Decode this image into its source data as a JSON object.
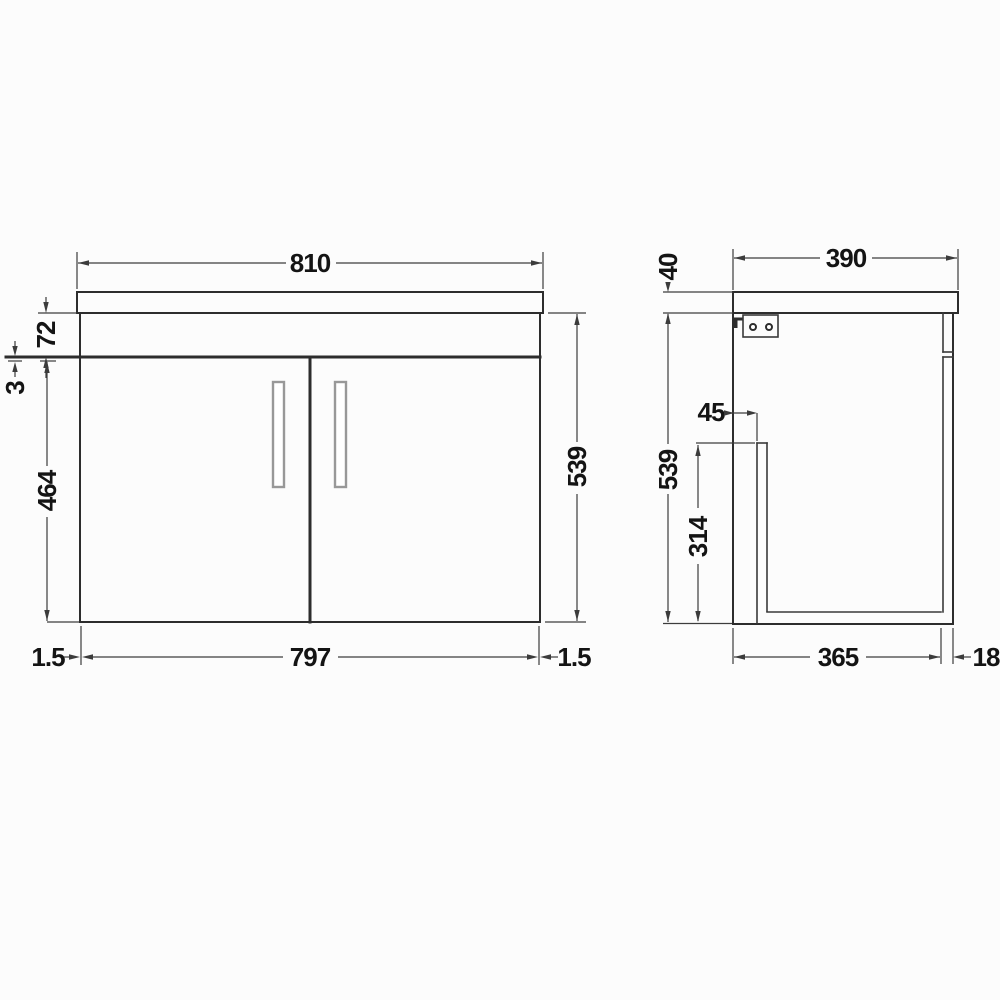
{
  "drawing": {
    "subject": "wall-hung two-door vanity unit technical drawing",
    "background": "#fcfcfc",
    "line_color": "#2d2d2d",
    "views": {
      "front": {
        "name": "front elevation",
        "dims": {
          "overall_width": "810",
          "worktop_to_door": "72",
          "door_top_gap": "3",
          "door_height": "464",
          "cabinet_height": "539",
          "gap_left": "1.5",
          "door_span": "797",
          "gap_right": "1.5"
        }
      },
      "side": {
        "name": "side elevation",
        "dims": {
          "overall_depth": "390",
          "worktop_thickness": "40",
          "bracket_offset": "45",
          "cabinet_height": "539",
          "inner_panel_height": "314",
          "cabinet_depth": "365",
          "door_thickness": "18"
        }
      }
    }
  }
}
